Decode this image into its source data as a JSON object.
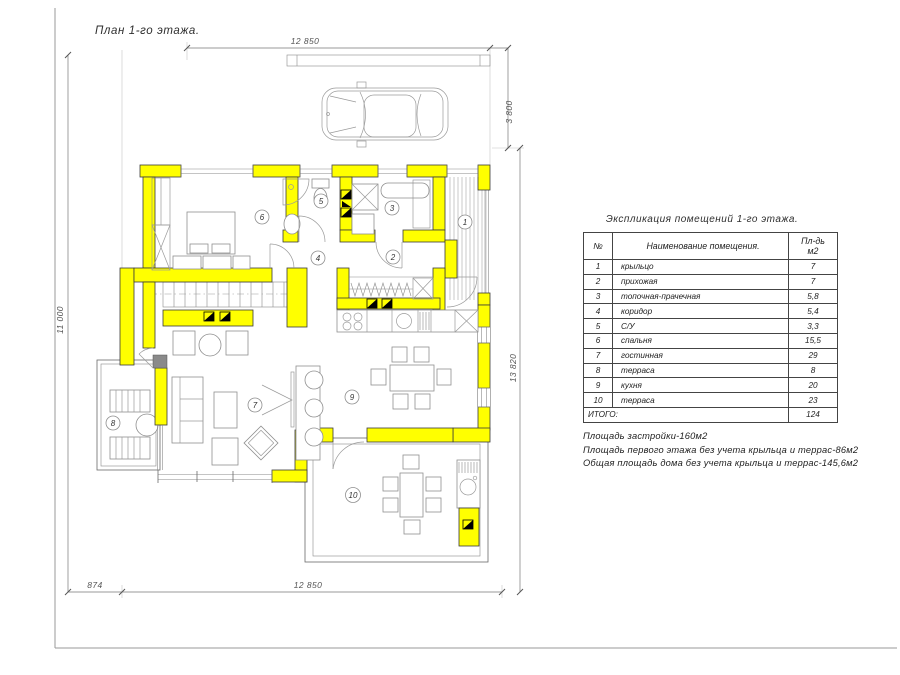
{
  "sheet": {
    "title": "План 1-го этажа."
  },
  "dimensions": {
    "top": "12 850",
    "parking_height": "3 800",
    "left_height": "11 000",
    "right_height": "13 820",
    "bottom_small": "874",
    "bottom": "12 850"
  },
  "room_labels": [
    "1",
    "2",
    "3",
    "4",
    "5",
    "6",
    "7",
    "8",
    "9",
    "10"
  ],
  "explication": {
    "title": "Экспликация помещений 1-го этажа.",
    "col_num": "№",
    "col_name": "Наименование помещения.",
    "col_area_line1": "Пл-дь",
    "col_area_line2": "м2",
    "rows": [
      {
        "num": "1",
        "name": "крыльцо",
        "area": "7"
      },
      {
        "num": "2",
        "name": "прихожая",
        "area": "7"
      },
      {
        "num": "3",
        "name": "топочная-прачечная",
        "area": "5,8"
      },
      {
        "num": "4",
        "name": "коридор",
        "area": "5,4"
      },
      {
        "num": "5",
        "name": "С/У",
        "area": "3,3"
      },
      {
        "num": "6",
        "name": "спальня",
        "area": "15,5"
      },
      {
        "num": "7",
        "name": "гостинная",
        "area": "29"
      },
      {
        "num": "8",
        "name": "терраса",
        "area": "8"
      },
      {
        "num": "9",
        "name": "кухня",
        "area": "20"
      },
      {
        "num": "10",
        "name": "терраса",
        "area": "23"
      }
    ],
    "total_label": "ИТОГО:",
    "total_area": "124"
  },
  "notes": [
    "Площадь застройки-160м2",
    "Площадь первого этажа без учета крыльца и террас-86м2",
    "Общая площадь дома без учета крыльца и террас-145,6м2"
  ],
  "colors": {
    "wall": "#ffff00",
    "line": "#555555",
    "hatch": "#b9b9b9"
  }
}
